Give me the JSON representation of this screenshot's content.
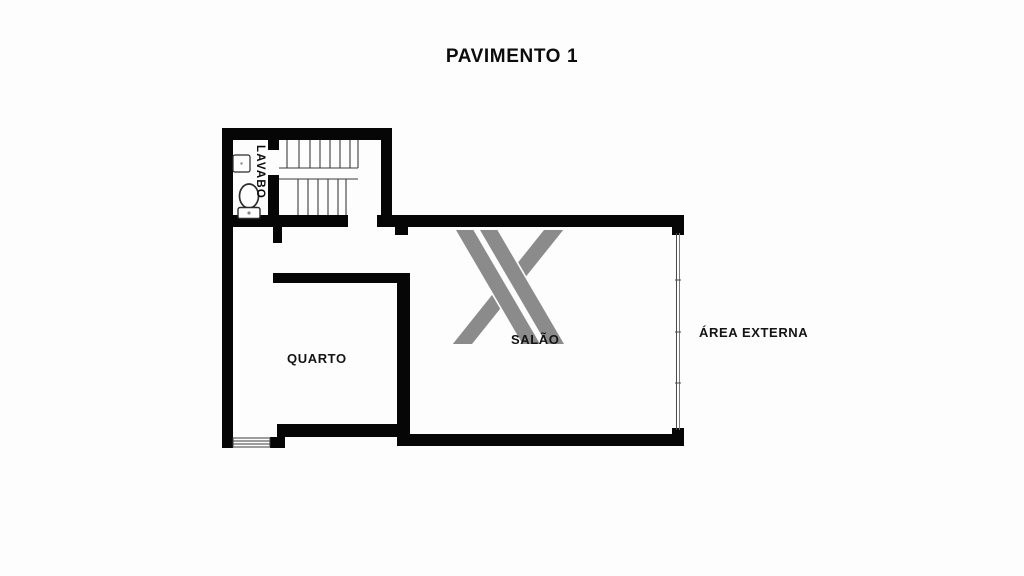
{
  "title": "PAVIMENTO 1",
  "rooms": {
    "lavabo": {
      "label": "LAVABO"
    },
    "quarto": {
      "label": "QUARTO"
    },
    "salao": {
      "label": "SALÃO"
    },
    "area_externa": {
      "label": "ÁREA EXTERNA"
    }
  },
  "watermark": {
    "name": "x-logo",
    "color": "#8b8b8b"
  },
  "colors": {
    "wall": "#060606",
    "background": "#fdfdfd",
    "thin_line": "#3c3c3c",
    "text": "#0c0c0c"
  }
}
